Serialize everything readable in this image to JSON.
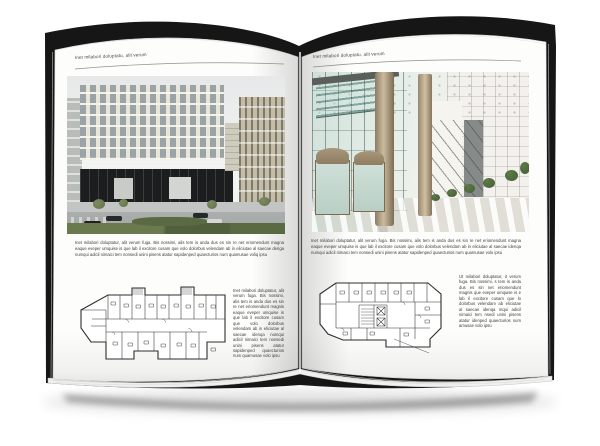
{
  "document": {
    "type": "open-book-brochure-mockup",
    "background": "#ffffff"
  },
  "book": {
    "pages": [
      {
        "side": "left",
        "header": "Inet milabori doluptatu, alit verum",
        "photo_subject": "modern office building exterior street render",
        "caption": "Inet milabori doluptatur, alit verum fuga. Bis nossimi, alis tem is anda dus es sin re net eriomendunt magna eaque eveper umquise is que lab il excitore cusam que volo dolorbus velendam ab in eliciutae al saecae deriga numqui adicil nimaici tem nonsedi unini pisens atatur sapidenped quaecturios num quamusae voliq ipsu",
        "side_text": "Inet milabori doluptatur, alit verum fuga. Bis nossimi, alis tem is anda dus es sin re net eriomendunt magnis eaque eveper umquise is que lab il excitore cusam que volo dolorbus velendam ab in eliciutae al saecae idenqa numqui adicil nimaici tem nonsedi unini pisens atatur sapidenped quaecturios num quamusae volo ipsu"
      },
      {
        "side": "right",
        "header": "Inet milabori doluptatu, alit verum",
        "photo_subject": "glass lobby interior with columns and revolving doors",
        "caption": "Inet milabori doluptatur, alit verum fuga. Bis nossimi, alis tem is anda dus es sin re net eriomendunt magna eaque eveper umquise is que lab il excitore cusam que volo dolorbus velendam ab in eliciutae al saecae idenqa numqui adicil nimaici tem nonsedi unini pisens atatur sapidenped quaecturios num quamusae volo ipsu",
        "side_text": "Ut milabori doluptatur, it verum fuga. Bis nossimi, s tem is anda dus es sin net eriomendunt magnis que eveper umquise is e lab il excitore cusam que lo dolorbus velendam ab eliciutae al saecae idenqa mqui adicil nimaici tem nsedi unini pisens atatur idenped quaecturios num amusae volo ipsu"
      }
    ]
  },
  "colors": {
    "paper": "#fdfdfc",
    "cover": "#161616",
    "header-text": "#474747",
    "body-text": "#3d3d3d",
    "rule": "#8f8f8f",
    "page-edge": "#c8c8c8",
    "sky": "#e7e8e9",
    "facade-cream": "#ddd9c8",
    "facade-window": "#9aa3a6",
    "band-gray": "#6d7173",
    "base-dark": "#1b1d1e",
    "storefront": "#c9cbc8",
    "beige-building": "#c6bca5",
    "street": "#a2a6a5",
    "hedge": "#5a6a42",
    "tree": "#69784f",
    "car-dark": "#26292c",
    "car-light": "#d5d7d8",
    "glass": "#b7d3cc",
    "glass-deep": "#8fbcb2",
    "mullion": "#46635b",
    "ceiling": "#f2f2ef",
    "column": "#b7a585",
    "bronze": "#8f7d63",
    "stone": "#ccc5b5",
    "wall-bright": "#f5f4ef",
    "door-gray": "#868a88",
    "plant": "#4c663c",
    "floor": "#e9e5d9",
    "plan-line": "#2e2e2e"
  }
}
